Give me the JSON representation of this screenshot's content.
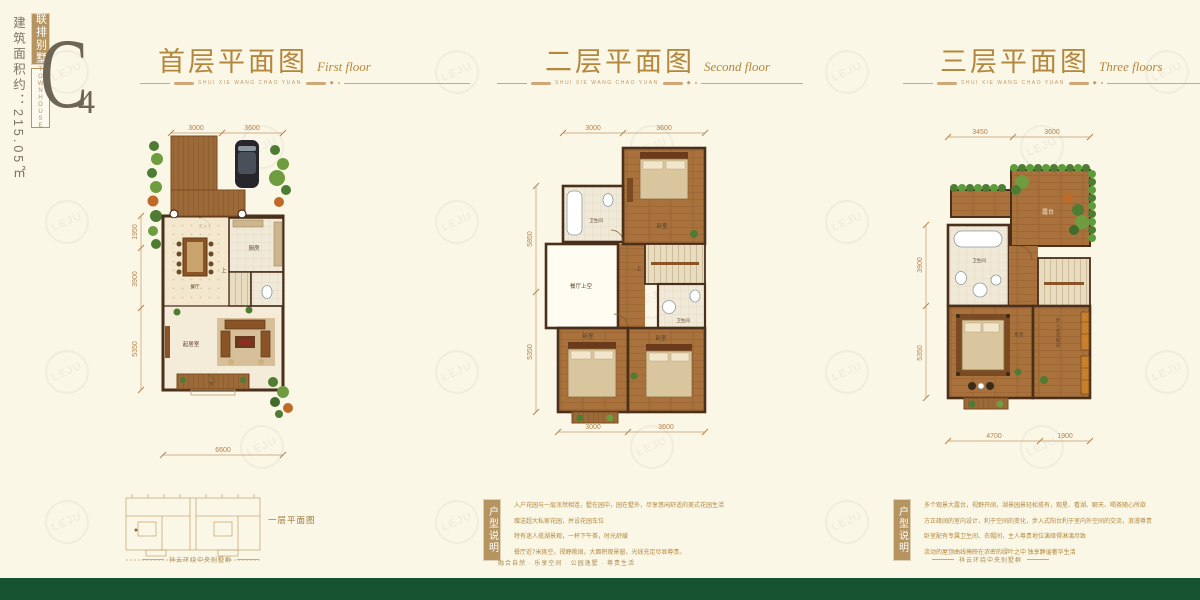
{
  "badge": {
    "area_label": "建筑面积约：215.05㎡",
    "type_cn": "联排别墅",
    "type_en": "TOWNHOUSE",
    "code_main": "C",
    "code_sub": "4"
  },
  "watermark": {
    "text": "LEJU"
  },
  "plans": [
    {
      "title": "首层平面图",
      "subtitle": "First floor",
      "caption": "SHUI XIE WANG CHAO YUAN",
      "dims_top": [
        "3000",
        "3600"
      ],
      "dims_left": [
        "1950",
        "3900",
        "5350"
      ],
      "dims_bottom": [
        "6600"
      ],
      "rooms": {
        "entry": "玄关",
        "kitchen": "厨房",
        "dining": "餐厅",
        "living": "起居室"
      },
      "stair_label": "上",
      "porch_label": "下"
    },
    {
      "title": "二层平面图",
      "subtitle": "Second floor",
      "caption": "SHUI XIE WANG CHAO YUAN",
      "dims_top": [
        "3000",
        "3600"
      ],
      "dims_left": [
        "5850",
        "5350"
      ],
      "dims_bottom": [
        "3000",
        "3600"
      ],
      "rooms": {
        "bath1": "卫生间",
        "bed1": "卧室",
        "void": "餐厅上空",
        "bath2": "卫生间",
        "bed2": "卧室",
        "bed3": "卧室"
      },
      "stair_label": "上"
    },
    {
      "title": "三层平面图",
      "subtitle": "Three floors",
      "caption": "SHUI XIE WANG CHAO YUAN",
      "dims_top": [
        "3450",
        "3600"
      ],
      "dims_left": [
        "3900",
        "5350"
      ],
      "dims_bottom": [
        "4700",
        "1900"
      ],
      "rooms": {
        "terrace": "露台",
        "bath": "卫生间",
        "bed": "卧室",
        "closet": "步入式衣帽间"
      }
    }
  ],
  "keyplan": {
    "label": "一层平面图"
  },
  "descriptions": [
    {
      "label": "户型说明",
      "lines": [
        "入户花园与一层浑然相连，墅在园中，园在墅外，尽享悠闲舒适的美式花园生活",
        "赠送超大私家花园，并设花园车位",
        "特有迷人揽湖景观，一杯下午茶，时光舒缓",
        "餐厅近7米挑空，视野敞阔，大面积观景窗，光线充足尽显尊贵。"
      ]
    },
    {
      "label": "户型说明",
      "lines": [
        "多个观景大露台，视野开阔，湖景园景轻松揽有，观星、看湖、聊天、喝茶随心所欲",
        "方正疏阔的室内设计，利于空间的变化，步入式阳台利于室内外空间的交流，浪漫尊贵",
        "卧室配有专属卫生间、衣帽间，主人尊贵地位演绎得淋漓尽致",
        "流动的屋顶曲线掩映在浓密的绿叶之中  独享静谧奢华生活"
      ]
    }
  ],
  "footer": {
    "side_motto": "祥云环绕中央别墅群",
    "center_motto": "融合自然 · 乐享空间 · 公园逸墅 · 尊贵生活"
  },
  "colors": {
    "background": "#fbf7e6",
    "accent_gold": "#b3873e",
    "badge_gold": "#b5945f",
    "wall_brown": "#4a2f1b",
    "wood": "#a9713c",
    "tile": "#f0e9d8",
    "plant_green": "#4e7c33",
    "footer_green": "#175231"
  }
}
